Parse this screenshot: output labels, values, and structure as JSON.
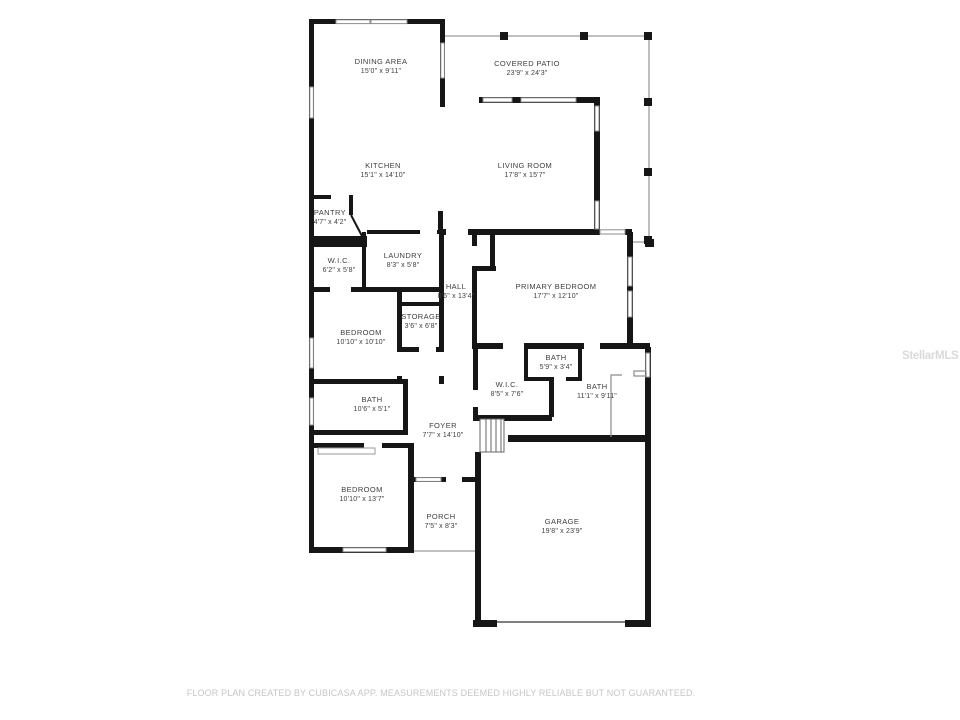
{
  "watermark": "StellarMLS",
  "footer": "FLOOR PLAN CREATED BY CUBICASA APP. MEASUREMENTS DEEMED HIGHLY RELIABLE BUT NOT GUARANTEED.",
  "colors": {
    "wall": "#161616",
    "label_text": "#3e3e3e",
    "footer_text": "#c6c6c6",
    "watermark_text": "#dadada",
    "window_stroke": "#8d8d8d",
    "patio_outline": "#9b9b9b"
  },
  "rooms": [
    {
      "id": "dining-area",
      "name": "DINING AREA",
      "dims": "15'0\" x 9'11\"",
      "x": 381,
      "y": 66
    },
    {
      "id": "covered-patio",
      "name": "COVERED PATIO",
      "dims": "23'9\" x 24'3\"",
      "x": 527,
      "y": 68
    },
    {
      "id": "kitchen",
      "name": "KITCHEN",
      "dims": "15'1\" x 14'10\"",
      "x": 383,
      "y": 170
    },
    {
      "id": "living-room",
      "name": "LIVING ROOM",
      "dims": "17'8\" x 15'7\"",
      "x": 525,
      "y": 170
    },
    {
      "id": "pantry",
      "name": "PANTRY",
      "dims": "4'7\" x 4'2\"",
      "x": 330,
      "y": 217
    },
    {
      "id": "wic-1",
      "name": "W.I.C.",
      "dims": "6'2\" x 5'8\"",
      "x": 339,
      "y": 265
    },
    {
      "id": "laundry",
      "name": "LAUNDRY",
      "dims": "8'3\" x 5'8\"",
      "x": 403,
      "y": 260
    },
    {
      "id": "hall",
      "name": "HALL",
      "dims": "8'6\" x 13'4\"",
      "x": 456,
      "y": 291
    },
    {
      "id": "primary-bedroom",
      "name": "PRIMARY BEDROOM",
      "dims": "17'7\" x 12'10\"",
      "x": 556,
      "y": 291
    },
    {
      "id": "storage",
      "name": "STORAGE",
      "dims": "3'6\" x 6'8\"",
      "x": 421,
      "y": 321
    },
    {
      "id": "bedroom-1",
      "name": "BEDROOM",
      "dims": "10'10\" x 10'10\"",
      "x": 361,
      "y": 337
    },
    {
      "id": "bath-small",
      "name": "BATH",
      "dims": "5'9\" x 3'4\"",
      "x": 556,
      "y": 362
    },
    {
      "id": "wic-2",
      "name": "W.I.C.",
      "dims": "8'5\" x 7'6\"",
      "x": 507,
      "y": 389
    },
    {
      "id": "bath-2",
      "name": "BATH",
      "dims": "11'1\" x 9'11\"",
      "x": 597,
      "y": 391
    },
    {
      "id": "bath-1",
      "name": "BATH",
      "dims": "10'6\" x 5'1\"",
      "x": 372,
      "y": 404
    },
    {
      "id": "foyer",
      "name": "FOYER",
      "dims": "7'7\" x 14'10\"",
      "x": 443,
      "y": 430
    },
    {
      "id": "bedroom-2",
      "name": "BEDROOM",
      "dims": "10'10\" x 13'7\"",
      "x": 362,
      "y": 494
    },
    {
      "id": "porch",
      "name": "PORCH",
      "dims": "7'5\" x 8'3\"",
      "x": 441,
      "y": 521
    },
    {
      "id": "garage",
      "name": "GARAGE",
      "dims": "19'8\" x 23'9\"",
      "x": 562,
      "y": 526
    }
  ]
}
